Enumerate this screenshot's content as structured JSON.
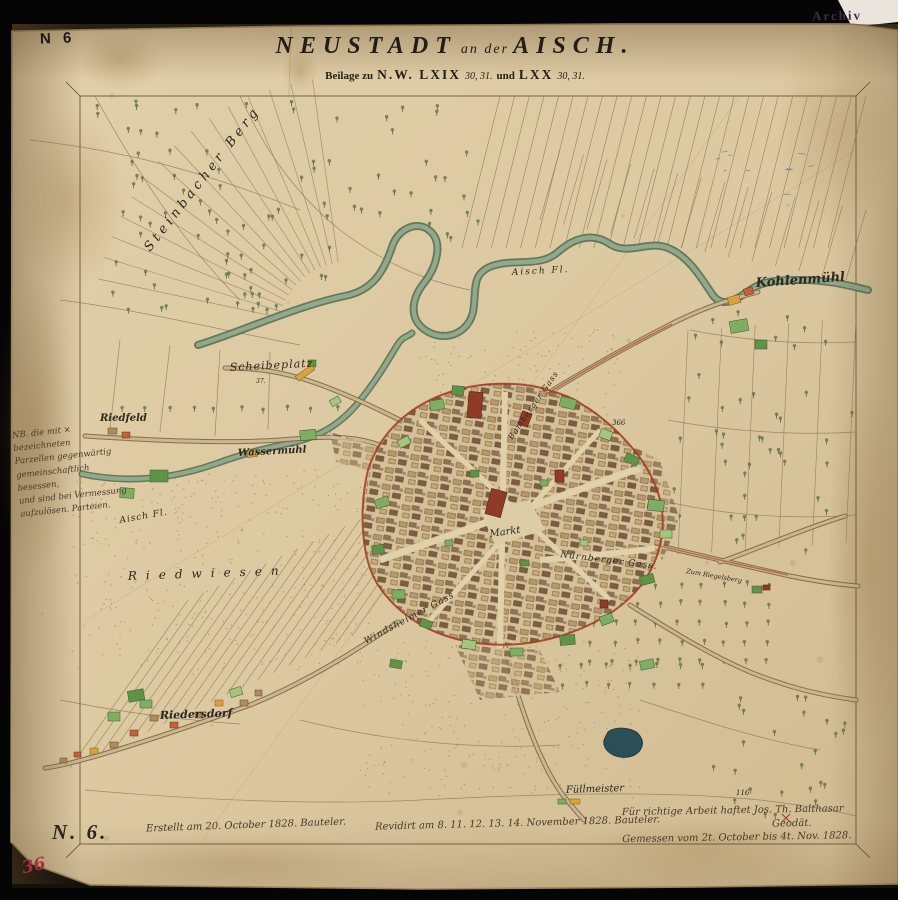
{
  "header": {
    "sheet_no": "N 6",
    "archiv_stamp": "Archiv",
    "title_main": "NEUSTADT",
    "title_mid": "an der",
    "title_end": "AISCH.",
    "subtitle": {
      "p1": "Beilage zu",
      "p2": "N.W. LXIX",
      "p3": "30, 31.",
      "p4": "und",
      "p5": "LXX",
      "p6": "30, 31."
    }
  },
  "margin_note": {
    "l1": "NB. die mit × bezeichneten",
    "l2": "Parzellen gegenwärtig",
    "l3": "gemeinschaftlich besessen,",
    "l4": "und sind bei Vermessung",
    "l5": "aufzulösen. Parteien."
  },
  "footer": {
    "corner_no": "N. 6.",
    "inscription_left": "Erstellt am 20. October 1828. Bauteler.",
    "inscription_center": "Revidirt am 8. 11. 12. 13. 14. November 1828. Bauteler.",
    "inscription_right_1": "Für richtige Arbeit haftet Jos. Th. Balthasar",
    "inscription_right_2": "Geodät.",
    "inscription_right_3": "Gemessen vom 2t. October bis 4t. Nov. 1828.",
    "red_mark": "36"
  },
  "map_labels": {
    "steinbacher_berg": "Steinbacher Berg",
    "aisch_upper": "Aisch Fl.",
    "kohlenmuehl": "Kohlenmühl",
    "scheibeplatz": "Scheibeplatz",
    "scheibeplatz_no": "37.",
    "riedfeld": "Riedfeld",
    "wassermuehl": "Wassermühl",
    "aisch_lower": "Aisch Fl.",
    "riedwiesen": "Riedwiesen",
    "markt": "Markt",
    "bamberger_gass": "Bamberger Gass",
    "nuernberger_gass": "Nürnberger Gass.",
    "windsheimer_gass": "Windsheimer Gass",
    "riedersdorf": "Riedersdorf",
    "fuellmeister": "Füllmeister",
    "zum_riegelsberg": "Zum Riegelsberg",
    "parcel_366": "366",
    "parcel_116": "116"
  },
  "colors": {
    "paper": "#dcc9a2",
    "town_boundary_red": "#a23820",
    "river_green": "#55704f",
    "garden_green": "#6f9e4f",
    "pond_dark": "#2c4e57"
  }
}
